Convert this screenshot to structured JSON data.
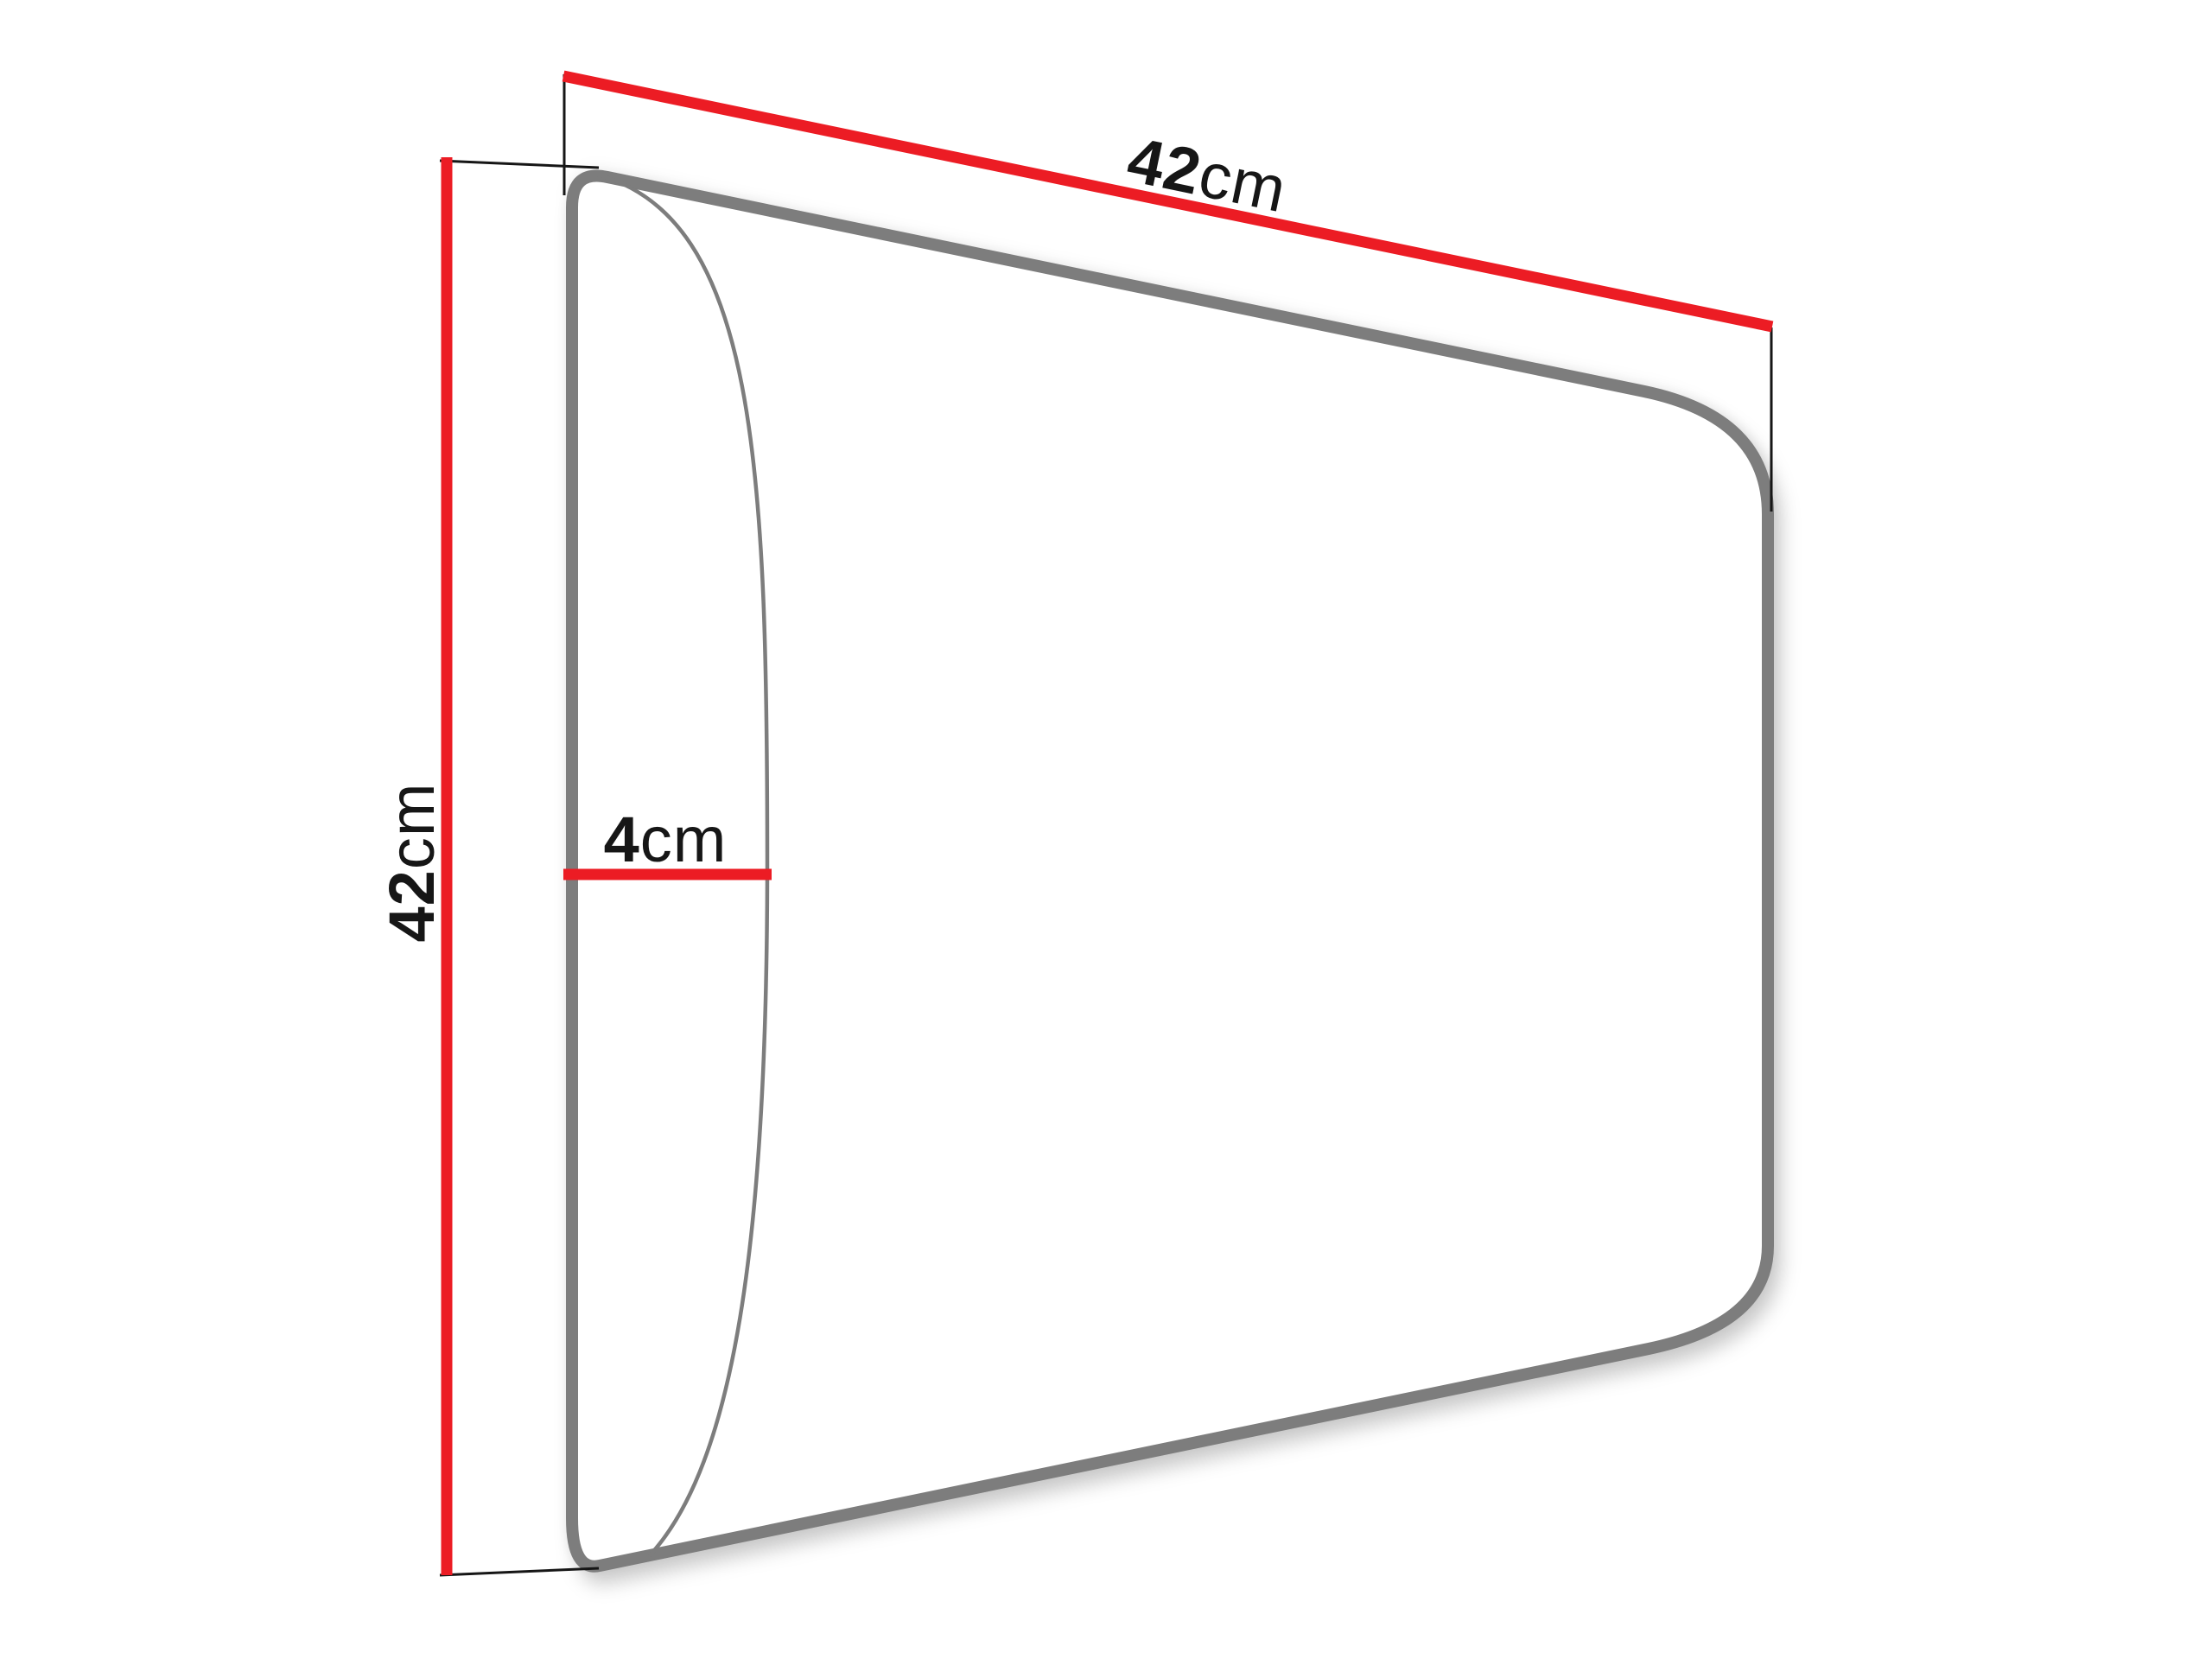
{
  "diagram": {
    "subject": "upholstered-wall-panel-perspective-drawing",
    "dimensions": {
      "width": {
        "value": "42",
        "unit": "cm"
      },
      "height": {
        "value": "42",
        "unit": "cm"
      },
      "depth": {
        "value": "4",
        "unit": "cm"
      }
    },
    "colors": {
      "dimension_line": "#ec1c24",
      "panel_outline": "#7d7d7d",
      "extension_line": "#161616",
      "label_text": "#161616",
      "background": "#ffffff"
    }
  }
}
